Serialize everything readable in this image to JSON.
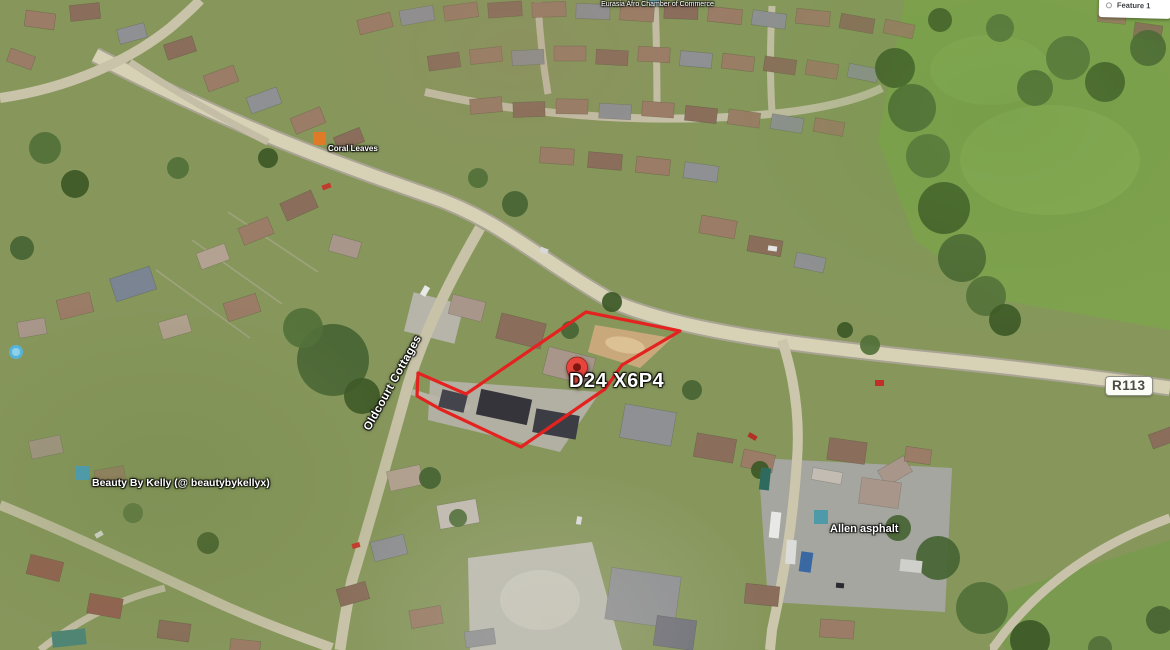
{
  "map": {
    "pin_label": "D24 X6P4",
    "street_label": "Oldcourt Cottages",
    "road_badge": "R113",
    "poi": {
      "coral": "Coral Leaves",
      "chamber": "Eurasia Afro Chamber of Commerce",
      "beauty": "Beauty By Kelly (@ beautybykellyx)",
      "allen": "Allen asphalt"
    },
    "legend": {
      "feature_label": "Feature 1"
    },
    "boundary": {
      "color": "#e42320",
      "points": [
        [
          586,
          312
        ],
        [
          680,
          331
        ],
        [
          622,
          365
        ],
        [
          605,
          389
        ],
        [
          521,
          447
        ],
        [
          440,
          409
        ],
        [
          417,
          396
        ],
        [
          418,
          373
        ],
        [
          466,
          394
        ]
      ]
    },
    "colors": {
      "pin": "#e7453c",
      "poi_icon_teal": "#4f9aa8",
      "poi_icon_orange": "#df7b27"
    }
  }
}
